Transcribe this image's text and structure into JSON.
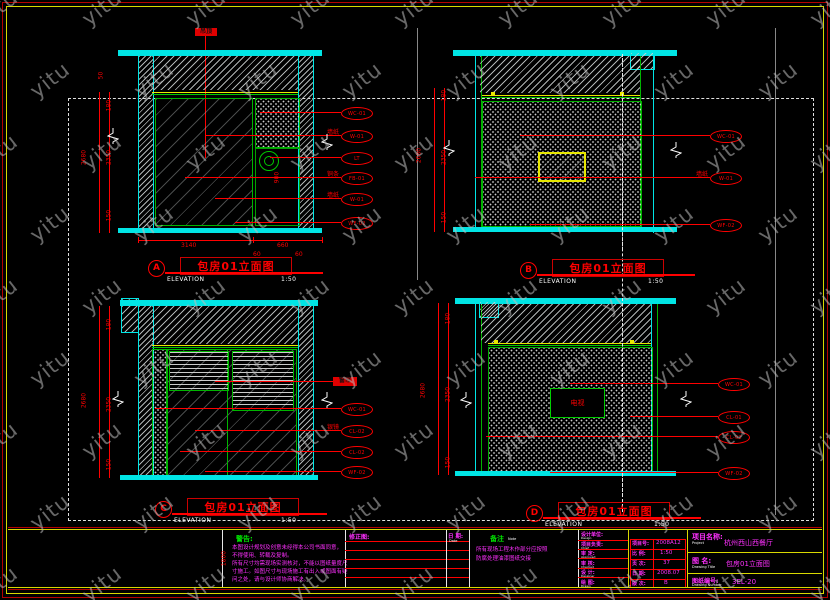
{
  "watermark": {
    "text": "yitu"
  },
  "panels": [
    {
      "letter": "A",
      "title": "包房01立面图",
      "subtitle": "ELEVATION",
      "scale": "1:50",
      "ceiling_tag": "吊顶",
      "dims_left": [
        "180",
        "2350",
        "150"
      ],
      "dims_total": "2680",
      "top_dim": "50",
      "extra_dim": "900",
      "dims_bottom": [
        "3140",
        "660"
      ],
      "dims_small": [
        "60",
        "60"
      ],
      "callouts": [
        {
          "label": "",
          "code": "WC-01"
        },
        {
          "label": "墙纸",
          "code": "W-01"
        },
        {
          "label": "",
          "code": "LT"
        },
        {
          "label": "铜条",
          "code": "FB-01"
        },
        {
          "label": "墙纸",
          "code": "W-01"
        },
        {
          "label": "",
          "code": "WF-02"
        }
      ]
    },
    {
      "letter": "B",
      "title": "包房01立面图",
      "subtitle": "ELEVATION",
      "scale": "1:50",
      "dims_left": [
        "180",
        "2350",
        "150"
      ],
      "dims_total": "2680",
      "callouts": [
        {
          "label": "",
          "code": "WC-01"
        },
        {
          "label": "墙纸",
          "code": "W-01"
        },
        {
          "label": "",
          "code": "WF-02"
        }
      ]
    },
    {
      "letter": "C",
      "title": "包房01立面图",
      "subtitle": "ELEVATION",
      "scale": "1:50",
      "curtain_tag": "窗帘",
      "dims_left": [
        "180",
        "2350",
        "150"
      ],
      "dims_total": "2680",
      "callouts": [
        {
          "label": "",
          "code": "WC-01"
        },
        {
          "label": "银镜",
          "code": "CL-02"
        },
        {
          "label": "",
          "code": "CL-02"
        },
        {
          "label": "",
          "code": "WF-02"
        }
      ]
    },
    {
      "letter": "D",
      "title": "包房01立面图",
      "subtitle": "ELEVATION",
      "scale": "1:50",
      "tv_label": "电视",
      "dims_left": [
        "180",
        "2350",
        "150"
      ],
      "dims_total": "2680",
      "callouts": [
        {
          "label": "",
          "code": "WC-01"
        },
        {
          "label": "",
          "code": "CL-01"
        },
        {
          "label": "",
          "code": "CL-02"
        },
        {
          "label": "",
          "code": "WF-02"
        }
      ]
    }
  ],
  "notes": {
    "title": "警告:",
    "lines": [
      "本图设计规划及创意未经得本公司书面同意，",
      "不得使用、转载及复制。",
      "所有尺寸均需现场实测核对，不能以图纸量度尺",
      "寸施工。如图尺寸与现场施工有出入或图面有疑",
      "问之处，请与设计师协商解决。"
    ]
  },
  "revision": {
    "header": "修正图:",
    "date_label": "日 期:",
    "date_sub": "Date",
    "side_dim": "1800"
  },
  "remark": {
    "title": "备注",
    "sub": "Note",
    "lines": [
      "所有现场工程木作部分应按照",
      "防腐处理油漆图纸交接"
    ]
  },
  "signatures": {
    "rows": [
      {
        "label": "设计单位:",
        "sub": "Design"
      },
      {
        "label": "项目负责:",
        "sub": "Chief"
      },
      {
        "label": "审 定:",
        "sub": "Approved"
      },
      {
        "label": "审 核:",
        "sub": "Checked"
      },
      {
        "label": "设 计:",
        "sub": "Designer"
      },
      {
        "label": "绘 图:",
        "sub": "Drawn"
      }
    ]
  },
  "titleblock": {
    "fields": [
      {
        "label": "项目号:",
        "sub": "Job No.",
        "value": "2008A12"
      },
      {
        "label": "比 例:",
        "sub": "Scale",
        "value": "1:50"
      },
      {
        "label": "页 次:",
        "sub": "Page",
        "value": "37"
      },
      {
        "label": "日 期:",
        "sub": "Date",
        "value": "2008.07"
      },
      {
        "label": "版 次:",
        "sub": "Version",
        "value": "B"
      }
    ],
    "project": {
      "label": "项目名称:",
      "sub": "Project",
      "value": "杭州西山西餐厅"
    },
    "drawing": {
      "label": "图 名:",
      "sub": "Drawing Title",
      "value": "包房01立面图"
    },
    "number": {
      "label": "图纸编号:",
      "sub": "Drawing Number",
      "value": "3EL-20"
    }
  }
}
